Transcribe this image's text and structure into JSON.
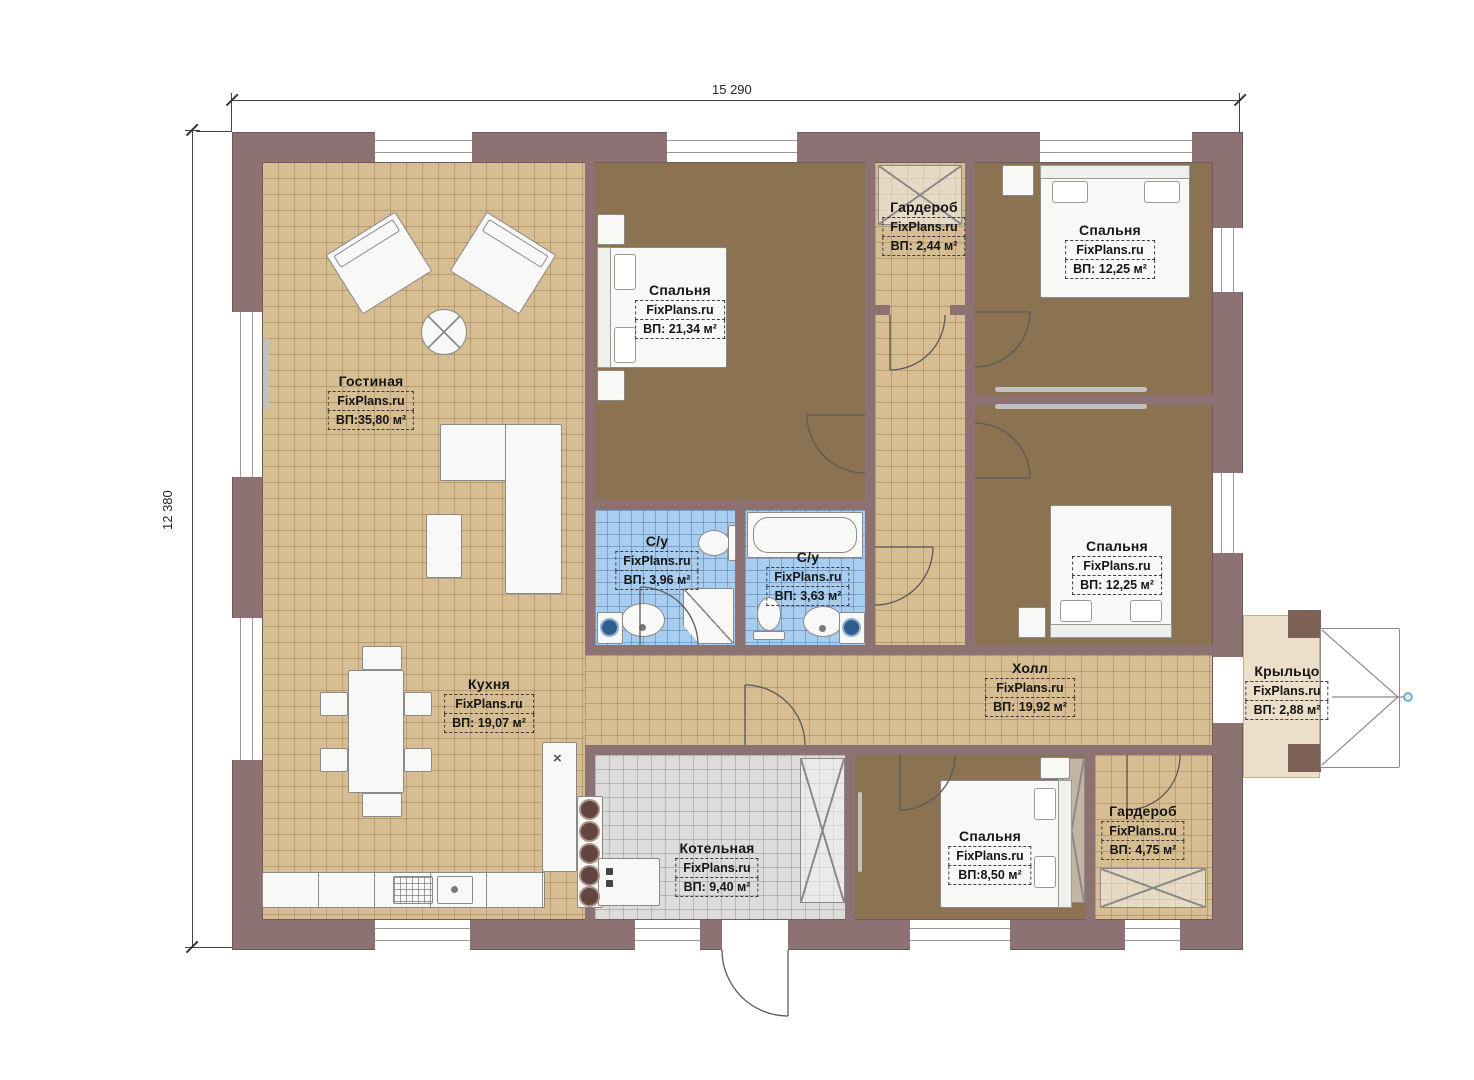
{
  "dimensions": {
    "width_label": "15 290",
    "height_label": "12 380"
  },
  "watermark": "FixPlans.ru",
  "rooms": {
    "living": {
      "name": "Гостиная",
      "area": "ВП:35,80 м²"
    },
    "bedroom_master": {
      "name": "Спальня",
      "area": "ВП: 21,34 м²"
    },
    "wardrobe_top": {
      "name": "Гардероб",
      "area": "ВП: 2,44 м²"
    },
    "bedroom_tr": {
      "name": "Спальня",
      "area": "ВП: 12,25 м²"
    },
    "bedroom_mr": {
      "name": "Спальня",
      "area": "ВП: 12,25 м²"
    },
    "bath_shower": {
      "name": "С/у",
      "area": "ВП: 3,96 м²"
    },
    "bath_tub": {
      "name": "С/у",
      "area": "ВП: 3,63 м²"
    },
    "kitchen": {
      "name": "Кухня",
      "area": "ВП: 19,07 м²"
    },
    "hall": {
      "name": "Холл",
      "area": "ВП: 19,92 м²"
    },
    "porch": {
      "name": "Крыльцо",
      "area": "ВП: 2,88 м²"
    },
    "boiler": {
      "name": "Котельная",
      "area": "ВП: 9,40 м²"
    },
    "bedroom_small": {
      "name": "Спальня",
      "area": "ВП:8,50 м²"
    },
    "wardrobe_bottom": {
      "name": "Гардероб",
      "area": "ВП: 4,75 м²"
    }
  },
  "colors": {
    "wall": "#8c7272",
    "floor_tile": "#d7bd92",
    "floor_carpet": "#8b7351",
    "floor_bath": "#a9cdee",
    "floor_boiler": "#dddcda",
    "porch": "#ebdfc9",
    "handle_marker": "#4a8fc0"
  }
}
